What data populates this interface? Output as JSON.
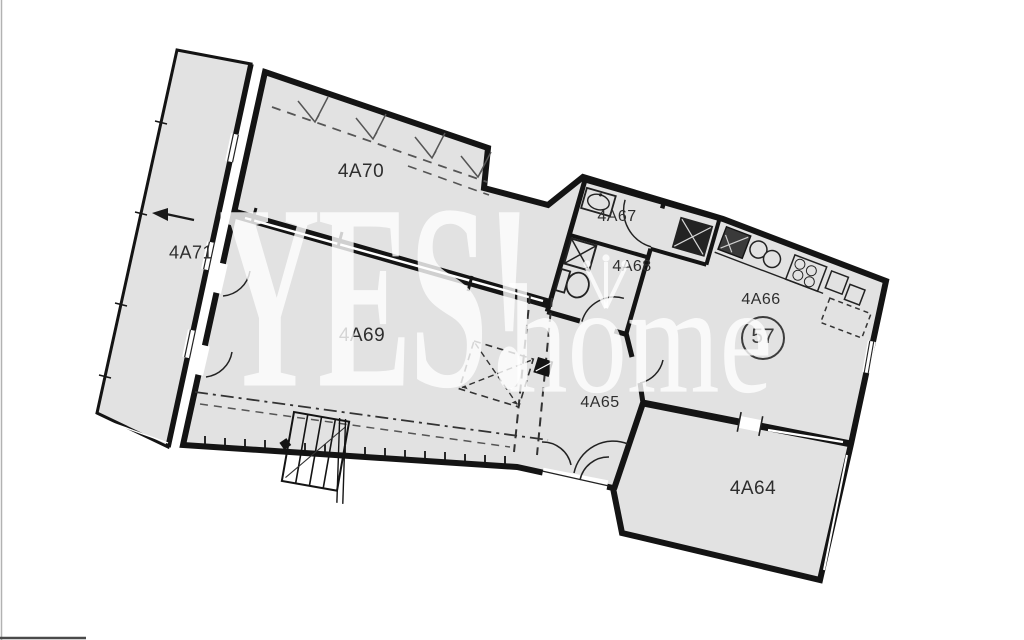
{
  "page": {
    "background": "#ffffff"
  },
  "plan": {
    "unit_badge": {
      "number": "57"
    },
    "rooms": {
      "r4a64": {
        "label": "4A64"
      },
      "r4a65": {
        "label": "4A65"
      },
      "r4a66": {
        "label": "4A66"
      },
      "r4a67": {
        "label": "4A67"
      },
      "r4a68": {
        "label": "4A68"
      },
      "r4a69": {
        "label": "4A69"
      },
      "r4a70": {
        "label": "4A70"
      },
      "r4a71": {
        "label": "4A71"
      }
    },
    "fixtures": [
      "kitchen-sink-icon",
      "stove-icon",
      "counter-icon",
      "washbasin-icon",
      "toilet-icon",
      "washer-icon",
      "shaft-icon",
      "stairs-icon",
      "entry-arrow-icon",
      "door-swing-icon",
      "window-icon",
      "skylight-hatch-icon"
    ],
    "colors": {
      "floor_fill": "#e2e2e2",
      "wall": "#141414",
      "label_text": "#2e2e2e",
      "watermark_text": "rgba(255,255,255,0.8)"
    }
  },
  "watermark": {
    "brand_primary": "YES!",
    "brand_secondary": "home"
  }
}
